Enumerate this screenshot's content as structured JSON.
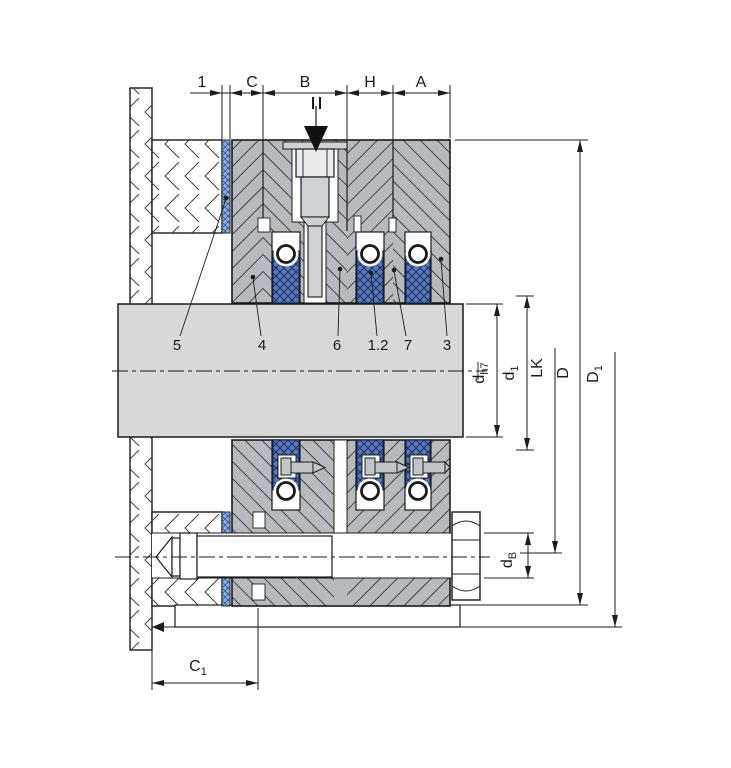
{
  "drawing": {
    "title_hint": "packing-seal-cross-section",
    "top_dimensions": {
      "gap": "1",
      "c": "C",
      "b": "B",
      "h": "H",
      "a": "A"
    },
    "part_numbers": {
      "p5": "5",
      "p4": "4",
      "p6": "6",
      "p1_2": "1.2",
      "p7": "7",
      "p3": "3"
    },
    "right_dimensions": {
      "shaft_dia": {
        "main": "d",
        "sub": "h7"
      },
      "sleeve_dia": {
        "main": "d",
        "sub": "1"
      },
      "bolt_circle": {
        "main": "LK",
        "sub": ""
      },
      "outer_dia": {
        "main": "D",
        "sub": ""
      },
      "flange_dia": {
        "main": "D",
        "sub": "1"
      },
      "bolt_dia": {
        "main": "d",
        "sub": "B"
      }
    },
    "bottom_dimensions": {
      "c1": {
        "main": "C",
        "sub": "1"
      }
    },
    "colors": {
      "housing_gray": "#b6babe",
      "shaft_gray": "#d6d8da",
      "screw_gray": "#cfd2d4",
      "packing_blue": "#5b78b4",
      "packing_line_blue": "#16336e",
      "gasket_blue": "#8fb0d6",
      "gasket_line_blue": "#33589c",
      "line_black": "#1c1c1c"
    }
  }
}
